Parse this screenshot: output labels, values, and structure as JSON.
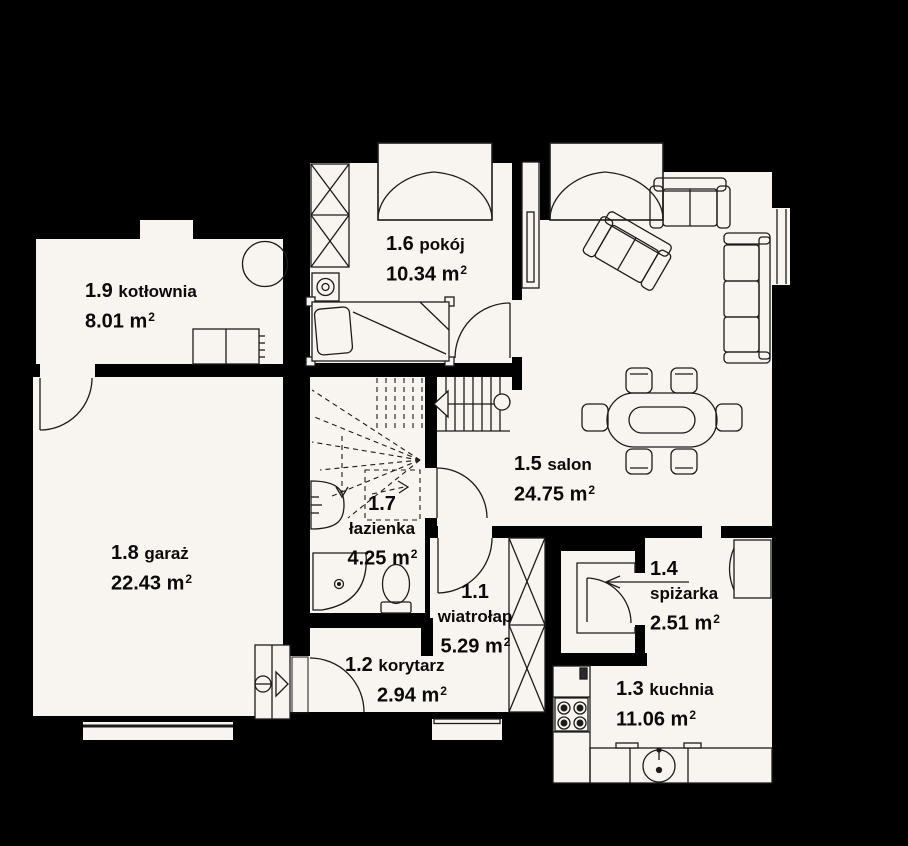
{
  "unit": {
    "base": "m",
    "exp": "2"
  },
  "rooms": {
    "wiatrolap": {
      "id": "1.1",
      "name": "wiatrołap",
      "area": "5.29"
    },
    "korytarz": {
      "id": "1.2",
      "name": "korytarz",
      "area": "2.94"
    },
    "kuchnia": {
      "id": "1.3",
      "name": "kuchnia",
      "area": "11.06"
    },
    "spizarka": {
      "id": "1.4",
      "name": "spiżarka",
      "area": "2.51"
    },
    "salon": {
      "id": "1.5",
      "name": "salon",
      "area": "24.75"
    },
    "pokoj": {
      "id": "1.6",
      "name": "pokój",
      "area": "10.34"
    },
    "lazienka": {
      "id": "1.7",
      "name": "łazienka",
      "area": "4.25"
    },
    "garaz": {
      "id": "1.8",
      "name": "garaż",
      "area": "22.43"
    },
    "kotlownia": {
      "id": "1.9",
      "name": "kotłownia",
      "area": "8.01"
    }
  },
  "colors": {
    "background": "#000000",
    "floor": "#f8f4f0",
    "wall": "#000000",
    "line": "#1c1c1c"
  }
}
